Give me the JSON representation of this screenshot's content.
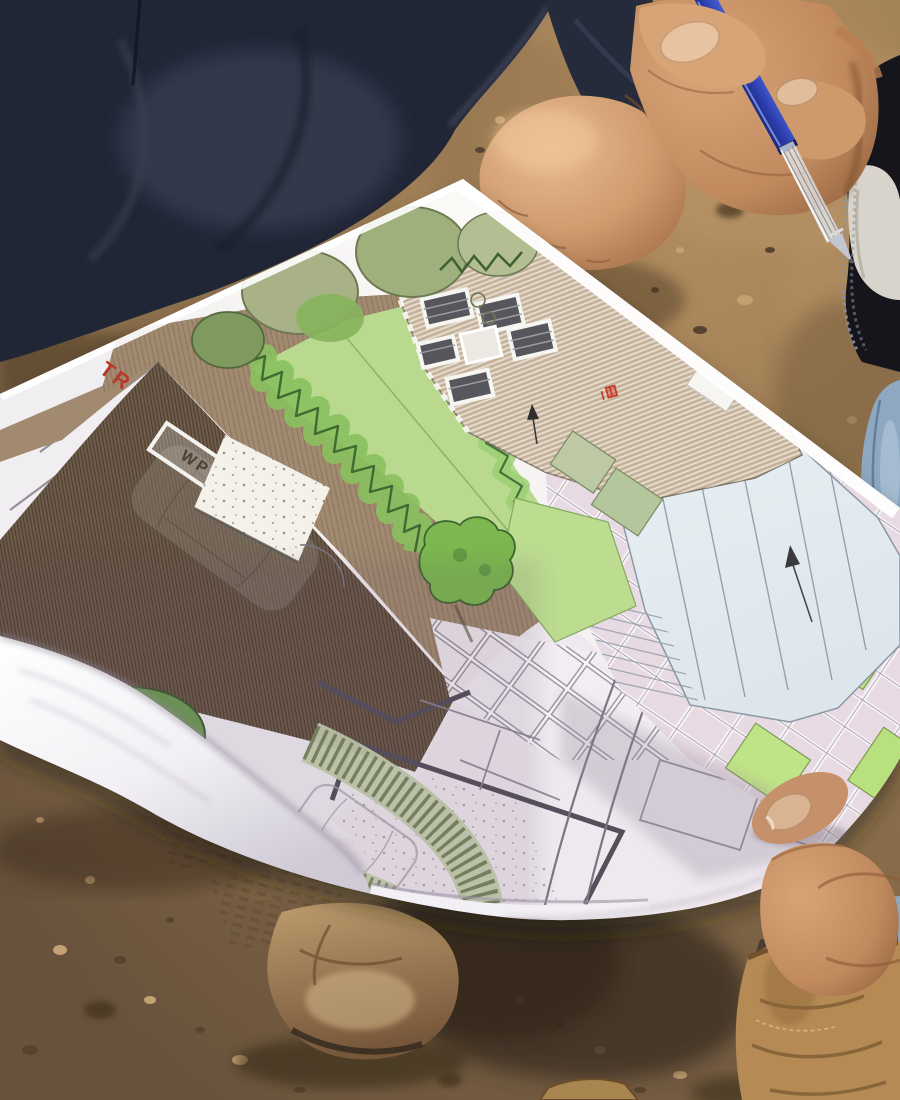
{
  "plan": {
    "label_tr": "TR",
    "label_wp": "WP"
  },
  "pen": {
    "brand_text": "atlantis"
  },
  "colors": {
    "paper": "#f6f2f0",
    "dirt": "#997a52",
    "dirt_light": "#b8966a",
    "dirt_dark": "#6e573e",
    "navy_jacket": "#202636",
    "skin": "#c08a5e",
    "pen_blue": "#2c3fae",
    "lawn_green": "#b9da8e",
    "hedge_green": "#6fae4e",
    "roof_tan": "#cdbaa3",
    "driveway_brown": "#6d5b49",
    "pool_blue": "#e9eff3",
    "paving_pink": "#e7dae3",
    "boot_tan": "#b58a55",
    "denim_blue": "#8fa8c2",
    "red_label": "#b8392c"
  }
}
